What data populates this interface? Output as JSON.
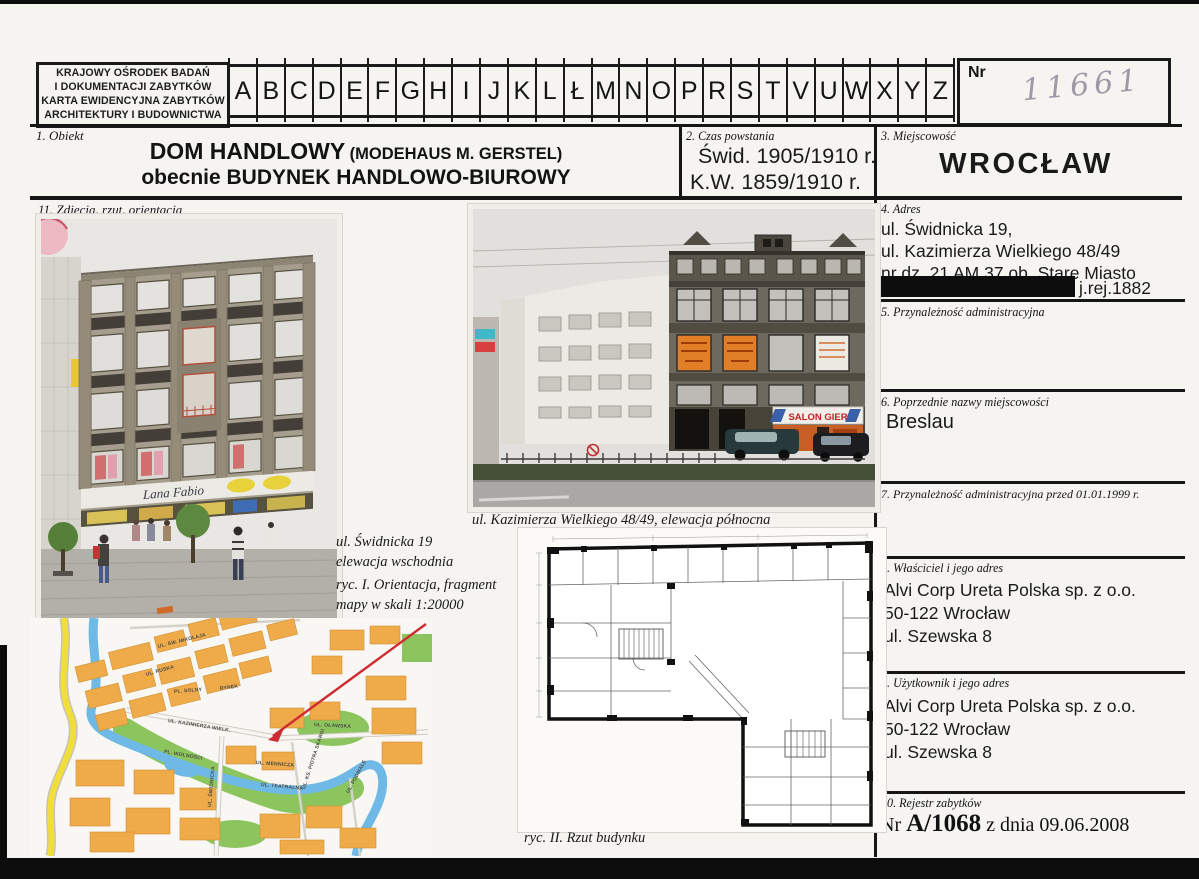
{
  "header": {
    "institution_lines": [
      "KRAJOWY OŚRODEK BADAŃ",
      "I DOKUMENTACJI ZABYTKÓW",
      "KARTA EWIDENCYJNA ZABYTKÓW",
      "ARCHITEKTURY I BUDOWNICTWA"
    ],
    "alphabet": [
      "A",
      "B",
      "C",
      "D",
      "E",
      "F",
      "G",
      "H",
      "I",
      "J",
      "K",
      "L",
      "Ł",
      "M",
      "N",
      "O",
      "P",
      "R",
      "S",
      "T",
      "V",
      "U",
      "W",
      "X",
      "Y",
      "Z"
    ],
    "nr_label": "Nr",
    "nr_value": "11661"
  },
  "fields": {
    "obiekt": {
      "label": "1. Obiekt",
      "line1_main": "DOM HANDLOWY",
      "line1_sub": "(MODEHAUS M. GERSTEL)",
      "line2": "obecnie BUDYNEK HANDLOWO-BIUROWY"
    },
    "czas_powstania": {
      "label": "2. Czas powstania",
      "lines": [
        "Świd. 1905/1910 r.",
        "K.W. 1859/1910 r."
      ]
    },
    "miejscowosc": {
      "label": "3. Miejscowość",
      "value": "WROCŁAW"
    },
    "adres": {
      "label": "4. Adres",
      "lines": [
        "ul. Świdnicka 19,",
        "ul. Kazimierza Wielkiego 48/49",
        "nr dz. 21 AM 37 ob. Stare Miasto"
      ],
      "suffix": "j.rej.1882"
    },
    "przynaleznosc": {
      "label": "5. Przynależność administracyjna",
      "rows": [
        {
          "key": "województwo",
          "value": "dolnośląskie"
        },
        {
          "key": "miasto",
          "value": "Wrocław"
        }
      ]
    },
    "poprzednie_nazwy": {
      "label": "6. Poprzednie nazwy miejscowości",
      "value": "Breslau"
    },
    "przynaleznosc_1999": {
      "label": "7. Przynależność administracyjna przed 01.01.1999 r.",
      "rows": [
        {
          "key": "województwo",
          "value": "wrocławskie"
        },
        {
          "key": "miasto",
          "value": "Wrocław"
        }
      ]
    },
    "wlasciciel": {
      "label": "8. Właściciel i jego adres",
      "lines": [
        "Alvi Corp Ureta Polska sp. z o.o.",
        "50-122 Wrocław",
        "ul. Szewska 8"
      ]
    },
    "uzytkownik": {
      "label": "9. Użytkownik i jego adres",
      "lines": [
        "Alvi Corp Ureta Polska sp. z o.o.",
        "50-122 Wrocław",
        "ul. Szewska 8"
      ]
    },
    "rejestr": {
      "label": "10. Rejestr zabytków",
      "prefix": "Nr ",
      "number": "A/1068",
      "suffix": " z dnia 09.06.2008"
    },
    "zdjecia": {
      "label": "11. Zdjęcia, rzut, orientacja"
    }
  },
  "captions": {
    "photo1_line1": "ul. Świdnicka 19",
    "photo1_line2": "elewacja wschodnia",
    "ryc1_line1": "ryc. I. Orientacja, fragment",
    "ryc1_line2": "mapy w skali 1:20000",
    "photo2": "ul. Kazimierza Wielkiego 48/49, elewacja północna",
    "ryc2": "ryc. II. Rzut budynku"
  },
  "photos": {
    "photo1_sign": "Lana Fabio",
    "photo2_sign": "SALON GIER"
  },
  "map": {
    "street_labels": [
      "UL. ŚW. MIKOŁAJA",
      "UL. RUSKA",
      "PL. SOLNY",
      "RYNEK",
      "UL. KAZIMIERZA WIELK.",
      "UL. OŁAWSKA",
      "PL. WOLNOŚCI",
      "UL. MENNICZA",
      "UL. TEATRALNA",
      "UL. ŚWIDNICKA",
      "UL. KS. PIOTRA SKARGI",
      "UL. PODWALE"
    ]
  },
  "colors": {
    "paper": "#f5f4f1",
    "line": "#161616",
    "handwriting": "#9d99a6",
    "map_block": "#efab4a",
    "map_green": "#8cc55e",
    "map_water": "#6fb9e6",
    "map_road": "#f2de3a",
    "arrow_red": "#cf2b33",
    "sign_red": "#c41e22",
    "shop_orange": "#c85f24"
  }
}
